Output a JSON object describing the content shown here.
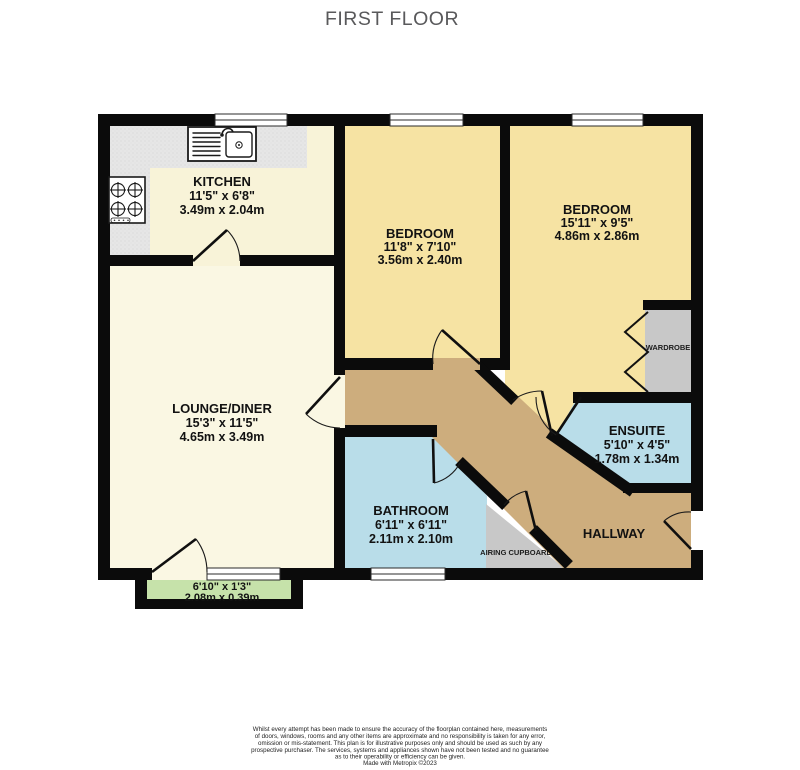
{
  "title": "FIRST FLOOR",
  "rooms": {
    "kitchen": {
      "name": "KITCHEN",
      "imperial": "11'5\" x 6'8\"",
      "metric": "3.49m x 2.04m"
    },
    "bedroom_middle": {
      "name": "BEDROOM",
      "imperial": "11'8\" x 7'10\"",
      "metric": "3.56m x 2.40m"
    },
    "bedroom_right": {
      "name": "BEDROOM",
      "imperial": "15'11\" x 9'5\"",
      "metric": "4.86m x 2.86m"
    },
    "lounge": {
      "name": "LOUNGE/DINER",
      "imperial": "15'3\" x 11'5\"",
      "metric": "4.65m x 3.49m"
    },
    "bathroom": {
      "name": "BATHROOM",
      "imperial": "6'11\" x 6'11\"",
      "metric": "2.11m x 2.10m"
    },
    "ensuite": {
      "name": "ENSUITE",
      "imperial": "5'10\" x 4'5\"",
      "metric": "1.78m x 1.34m"
    },
    "hallway": {
      "name": "HALLWAY"
    },
    "wardrobe": {
      "name": "WARDROBE"
    },
    "airing_cupboard": {
      "name": "AIRING CUPBOARD"
    },
    "balcony": {
      "imperial": "6'10\" x 1'3\"",
      "metric": "2.08m x 0.39m"
    }
  },
  "footer": {
    "disclaimer_lines": [
      "Whilst every attempt has been made to ensure the accuracy of the floorplan contained here, measurements",
      "of doors, windows, rooms and any other items are approximate and no responsibility is taken for any error,",
      "omission or mis-statement. This plan is for illustrative purposes only and should be used as such by any",
      "prospective purchaser. The services, systems and appliances shown have not been tested and no guarantee",
      "as to their operability or efficiency can be given."
    ],
    "credit": "Made with Metropix ©2023"
  },
  "colors": {
    "wall": "#0b0b0b",
    "bedroom_yellow": "#F6E3A3",
    "lounge_cream": "#FAF7E3",
    "kitchen_cream": "#F8F3D8",
    "wet_room_blue": "#B9DDE9",
    "hallway_tan": "#CDAD7D",
    "balcony_green": "#C6E2AA",
    "storage_grey": "#C8C8C8",
    "counter_grey": "#E6E6E6"
  }
}
